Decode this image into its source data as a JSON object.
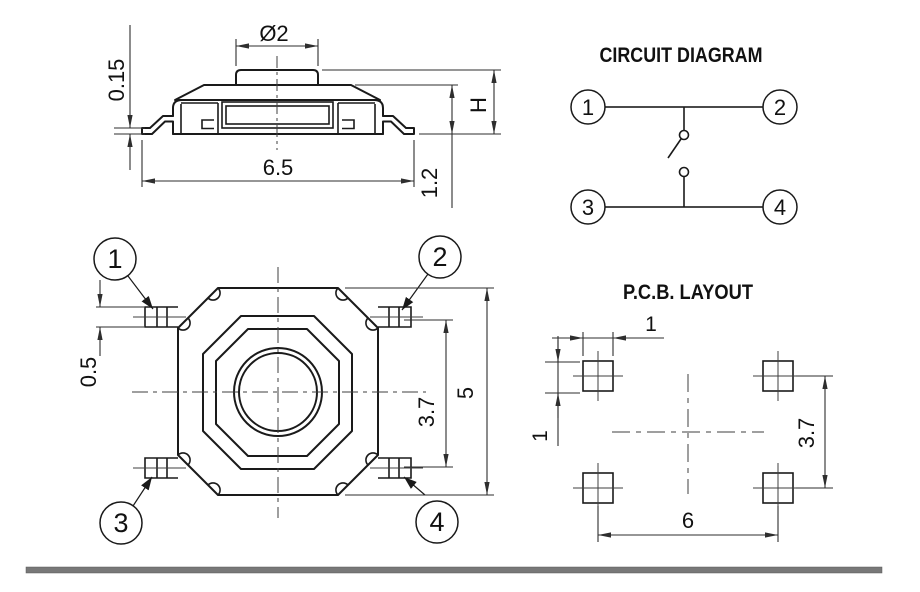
{
  "side_view": {
    "dia": "Ø2",
    "thickness": "0.15",
    "width": "6.5",
    "height": "H",
    "body_height": "1.2"
  },
  "top_view": {
    "pins": [
      "1",
      "2",
      "3",
      "4"
    ],
    "lead_width": "0.5",
    "inner_span": "3.7",
    "body_size": "5"
  },
  "circuit": {
    "title": "CIRCUIT DIAGRAM",
    "terminals": [
      "1",
      "2",
      "3",
      "4"
    ]
  },
  "pcb": {
    "title": "P.C.B. LAYOUT",
    "pad_width": "1",
    "pad_height": "1",
    "row_pitch": "3.7",
    "col_pitch": "6"
  },
  "colors": {
    "line": "#1a1a1a",
    "dimension": "#2e2e2e",
    "footer_bar": "#787878"
  }
}
